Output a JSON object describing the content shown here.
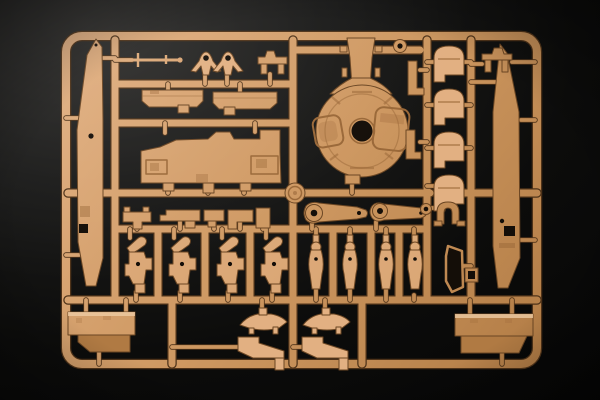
{
  "scene": {
    "description": "Photograph of a tan injection-molded plastic model-kit sprue (tank parts frame) lying on a black background, lit from the upper left",
    "background_center": "#0c0c0b",
    "background_edge": "#2d2c2a",
    "background_deep": "#040404",
    "sprue_marker": "small circular embossed runner medallion at the center-left runner junction (lettering too small to read)"
  },
  "colors": {
    "plastic_light": "#e2b082",
    "plastic_mid": "#cd9760",
    "plastic_dark": "#b07a43",
    "plastic_outline": "#6b4623",
    "runner_shadow": "#4f3319",
    "hole_dark": "#140e08",
    "detail_shadow": "#9a6838",
    "highlight": "#eecba2"
  },
  "parts_inventory": [
    "long tapered side-skirt panel (left edge)",
    "long tapered side-skirt panel (right edge)",
    "thin antenna rod with cross pegs",
    "two small periscope-style brackets with round holes",
    "two small bench-shaped brackets (top center and top right)",
    "two rectangular fender strips",
    "large stepped hull side panel with two latch details",
    "circular turret base plate with neck, center bore and two hatches",
    "two small eyelet rings",
    "two small angle bars",
    "four dome-capped cover parts in a column",
    "two suspension swing arms with bored bosses",
    "U-shaped tow shackle",
    "row of five small mounting brackets",
    "four suspension/final-drive units in a row",
    "four vertical shock-absorber parts in a row",
    "thin triangular panel and small clamp bracket",
    "two boat-shaped hull appliqué parts",
    "two angled plate brackets with feet",
    "rectangular stowage box (bottom left)",
    "rectangular stowage box (bottom right)",
    "circular sprue medallion at runner junction"
  ]
}
